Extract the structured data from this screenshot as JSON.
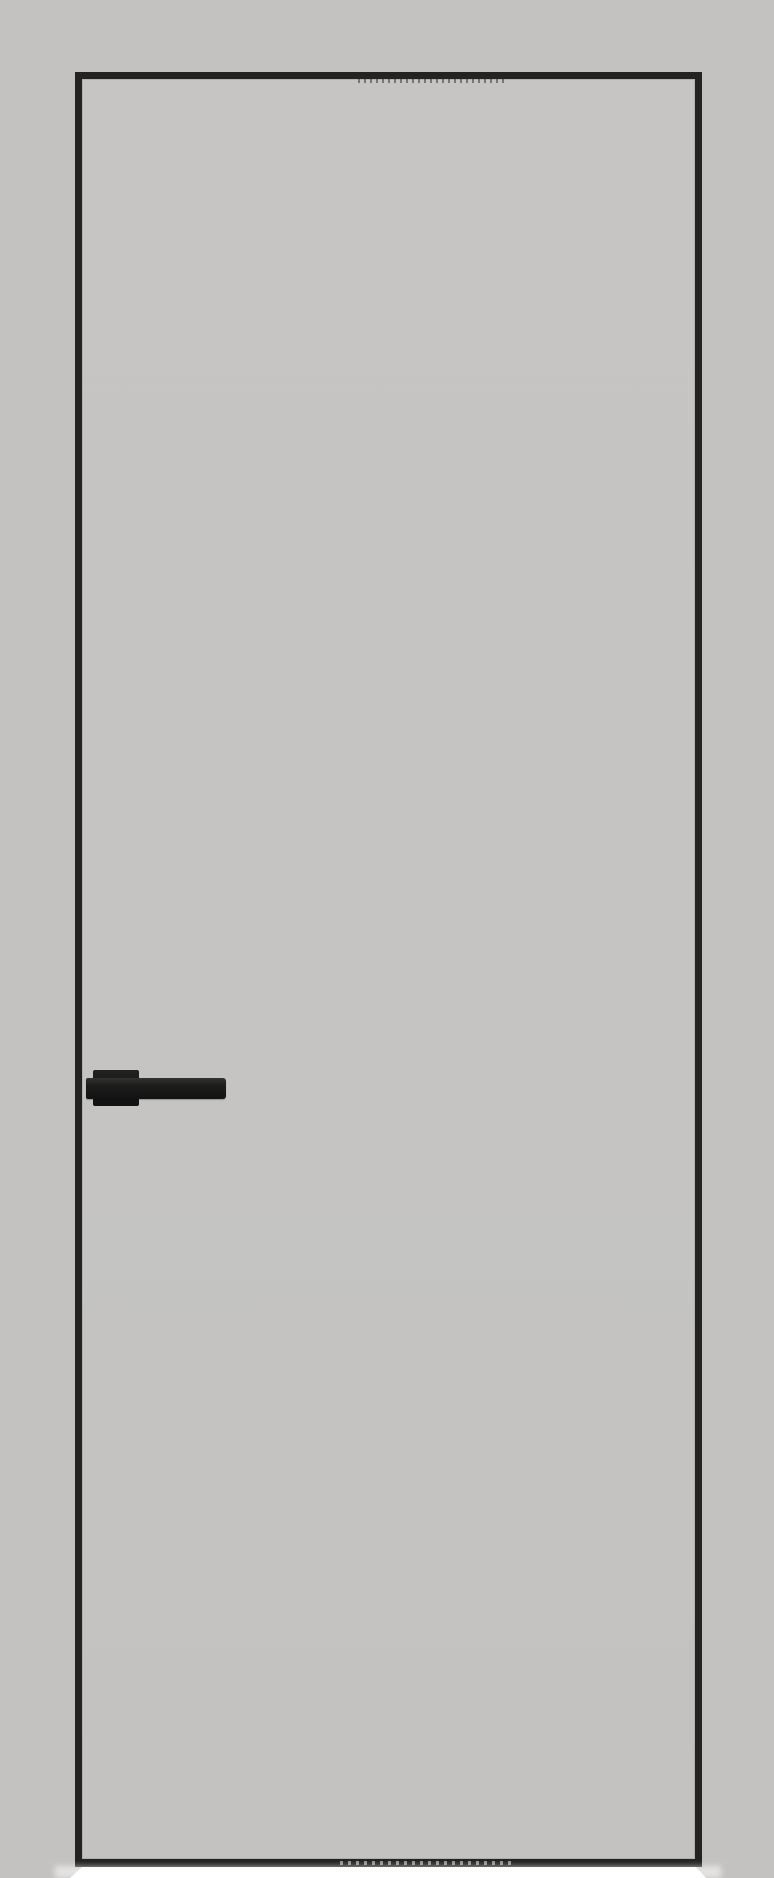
{
  "scene": {
    "type": "product-photo",
    "subject": "interior door leaf with concealed black edge frame and black lever handle",
    "parts": [
      "backdrop",
      "door-frame",
      "door-leaf",
      "door-handle-rosette",
      "door-handle-lever",
      "floor-highlight"
    ]
  },
  "colors": {
    "background": "#c3c2c0",
    "door_surface": "#c5c4c2",
    "frame": "#232322",
    "handle": "#191919",
    "floor_highlight": "#ffffff"
  }
}
